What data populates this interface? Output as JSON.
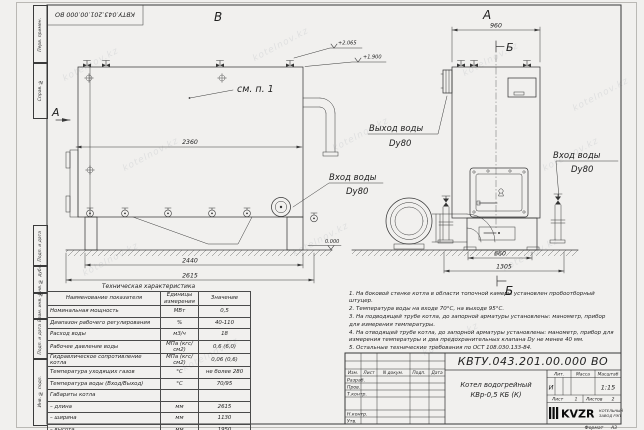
{
  "doc_number": "КВТУ.043.201.00.000 ВО",
  "watermark": "kotelnov.kz",
  "margin_labels": {
    "perv_primen": "Перв. примен.",
    "sprav_no": "Справ. №",
    "podp_data_1": "Подп. и дата",
    "inv_dubl": "Инв. № дубл.",
    "vzam_inv": "Взам. инв. №",
    "podp_data_2": "Подп. и дата",
    "inv_podl": "Инв. № подл."
  },
  "views": {
    "label_b": "В",
    "label_a": "А",
    "label_a_arrow": "А",
    "label_sec": "Б",
    "see_item": "см. п. 1",
    "elev_1": "+2.065",
    "elev_2": "+1.900",
    "elev_0": "0.000",
    "dim_2360": "2360",
    "dim_2440": "2440",
    "dim_2615": "2615",
    "dim_960": "960",
    "dim_660": "660",
    "dim_1305": "1305",
    "water_out_1": "Выход воды",
    "water_out_2": "Dy80",
    "water_in_left_1": "Вход воды",
    "water_in_left_2": "Dy80",
    "water_in_right_1": "Вход воды",
    "water_in_right_2": "Dy80"
  },
  "tech_table": {
    "title": "Техническая характеристика",
    "headers": [
      "Наименование показателя",
      "Единицы измерения",
      "Значение"
    ],
    "rows": [
      {
        "name": "Номинальная мощность",
        "unit": "МВт",
        "value": "0,5"
      },
      {
        "name": "Диапазон рабочего регулирования",
        "unit": "%",
        "value": "40-110"
      },
      {
        "name": "Расход воды",
        "unit": "м3/ч",
        "value": "18"
      },
      {
        "name": "Рабочее давление воды",
        "unit": "МПа (кгс/см2)",
        "value": "0,6 (6,0)"
      },
      {
        "name": "Гидравлическое сопротивление котла",
        "unit": "МПа (кгс/см2)",
        "value": "0,06 (0,6)"
      },
      {
        "name": "Температура уходящих газов",
        "unit": "°С",
        "value": "не более 280"
      },
      {
        "name": "Температура воды (Вход/Выход)",
        "unit": "°С",
        "value": "70/95"
      },
      {
        "name": "Габариты котла",
        "unit": "",
        "value": ""
      },
      {
        "name": "– длина",
        "unit": "мм",
        "value": "2615"
      },
      {
        "name": "– ширина",
        "unit": "мм",
        "value": "1130"
      },
      {
        "name": "– высота",
        "unit": "мм",
        "value": "1950"
      }
    ]
  },
  "notes": [
    "1. На боковой стенке котла в области топочной камеры установлен пробоотборный штуцер.",
    "2. Температура воды на входе 70°С, на выходе 95°С.",
    "3. На подводящей трубе котла, до запорной арматуры установлены: манометр, прибор для измерения температуры.",
    "4. На отводящей трубе котла, до запорной арматуры установлены: манометр, прибор для измерения температуры и два предохранительных клапана Dу не менее 40 мм.",
    "5. Остальные технические требования по ОСТ 108.030.133-84."
  ],
  "title_block": {
    "doc_number": "КВТУ.043.201.00.000 ВО",
    "col_izm": "Изм.",
    "col_list": "Лист",
    "col_ndoc": "N докум.",
    "col_podp": "Подп.",
    "col_data": "Дата",
    "row_razrab": "Разраб.",
    "row_prov": "Пров.",
    "row_tkontr": "Т.контр.",
    "row_nkontr": "Н.контр.",
    "row_utv": "Утв.",
    "name_line1": "Котел водогрейный",
    "name_line2": "КВр-0,5 КБ (К)",
    "lit_label": "Лит.",
    "massa_label": "Масса",
    "masshtab_label": "Масштаб",
    "lit_value": "И",
    "masshtab_value": "1:15",
    "list_label": "Лист",
    "list_value": "1",
    "listov_label": "Листов",
    "listov_value": "2",
    "logo_text": "KVZR",
    "logo_sub1": "КОТЕЛЬНЫЙ",
    "logo_sub2": "ЗАВОД РЭП",
    "format_label": "Формат",
    "format_value": "А3"
  }
}
